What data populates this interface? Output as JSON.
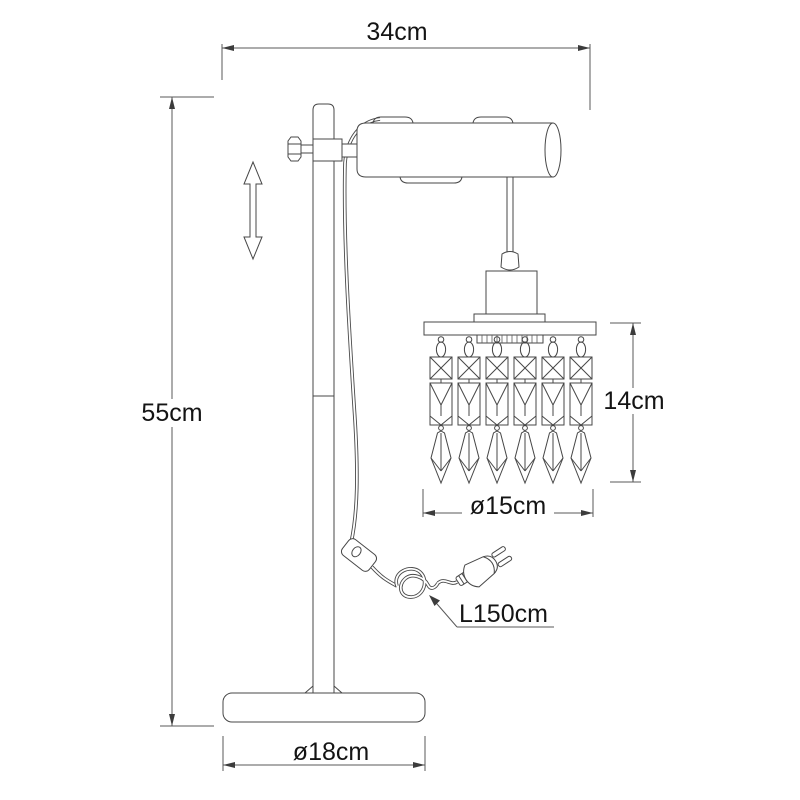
{
  "drawing": {
    "labels": {
      "width_top": "34cm",
      "height_total": "55cm",
      "pendant_drop": "14cm",
      "shade_diameter": "ø15cm",
      "base_diameter": "ø18cm",
      "cable_length": "L150cm"
    },
    "crystal_strand_count": 6,
    "colors": {
      "line": "#474747",
      "dimension_line": "#5a5a5a",
      "text": "#141414",
      "background": "#ffffff"
    }
  }
}
